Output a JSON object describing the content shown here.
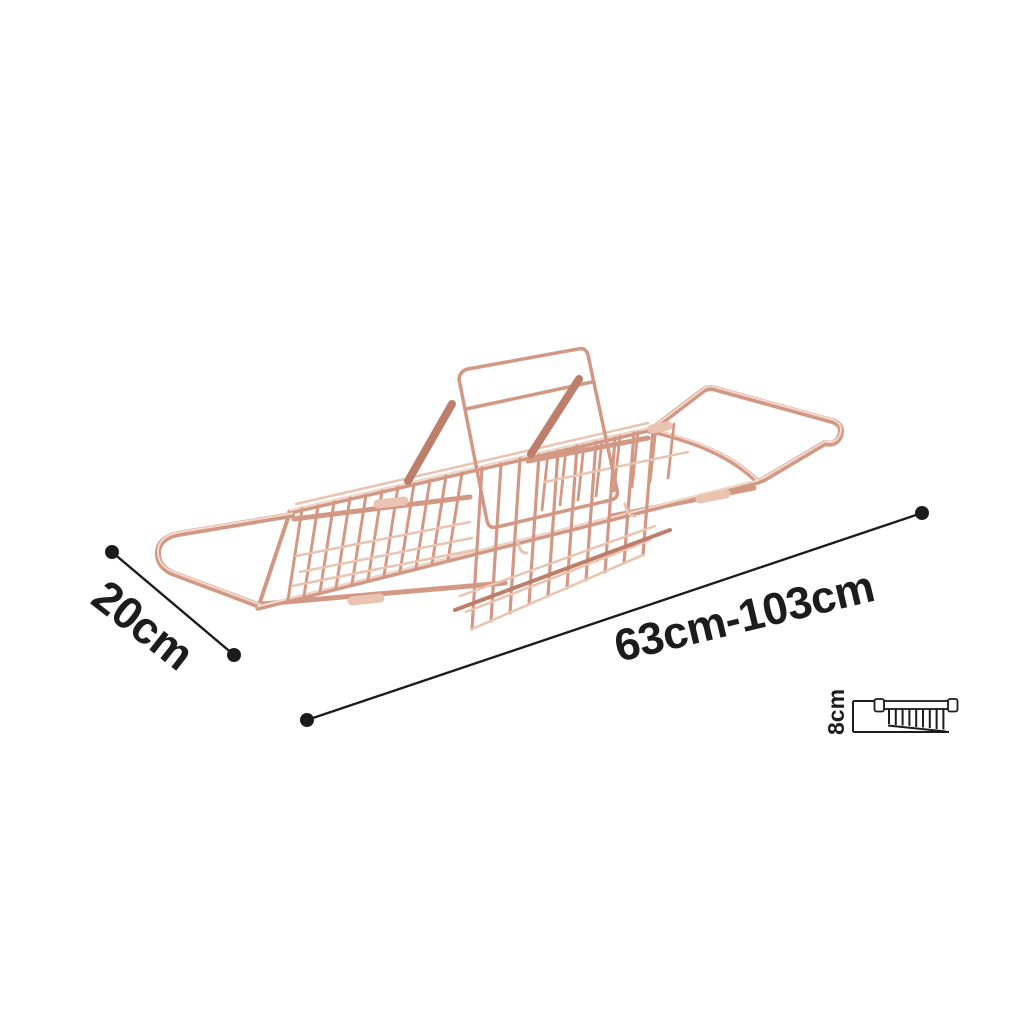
{
  "background": "#ffffff",
  "annotation": {
    "color": "#1c1c1e",
    "labels": {
      "width": "20cm",
      "length": "63cm-103cm",
      "height": "8cm"
    }
  },
  "product": {
    "illustration": "expandable-bathtub-caddy-tray-wireframe",
    "finish": "rose-gold",
    "finish_colors": {
      "base": "#d29884",
      "dark": "#bd7f6b",
      "light": "#eac3b1",
      "highlight": "#f6e0d5"
    }
  }
}
